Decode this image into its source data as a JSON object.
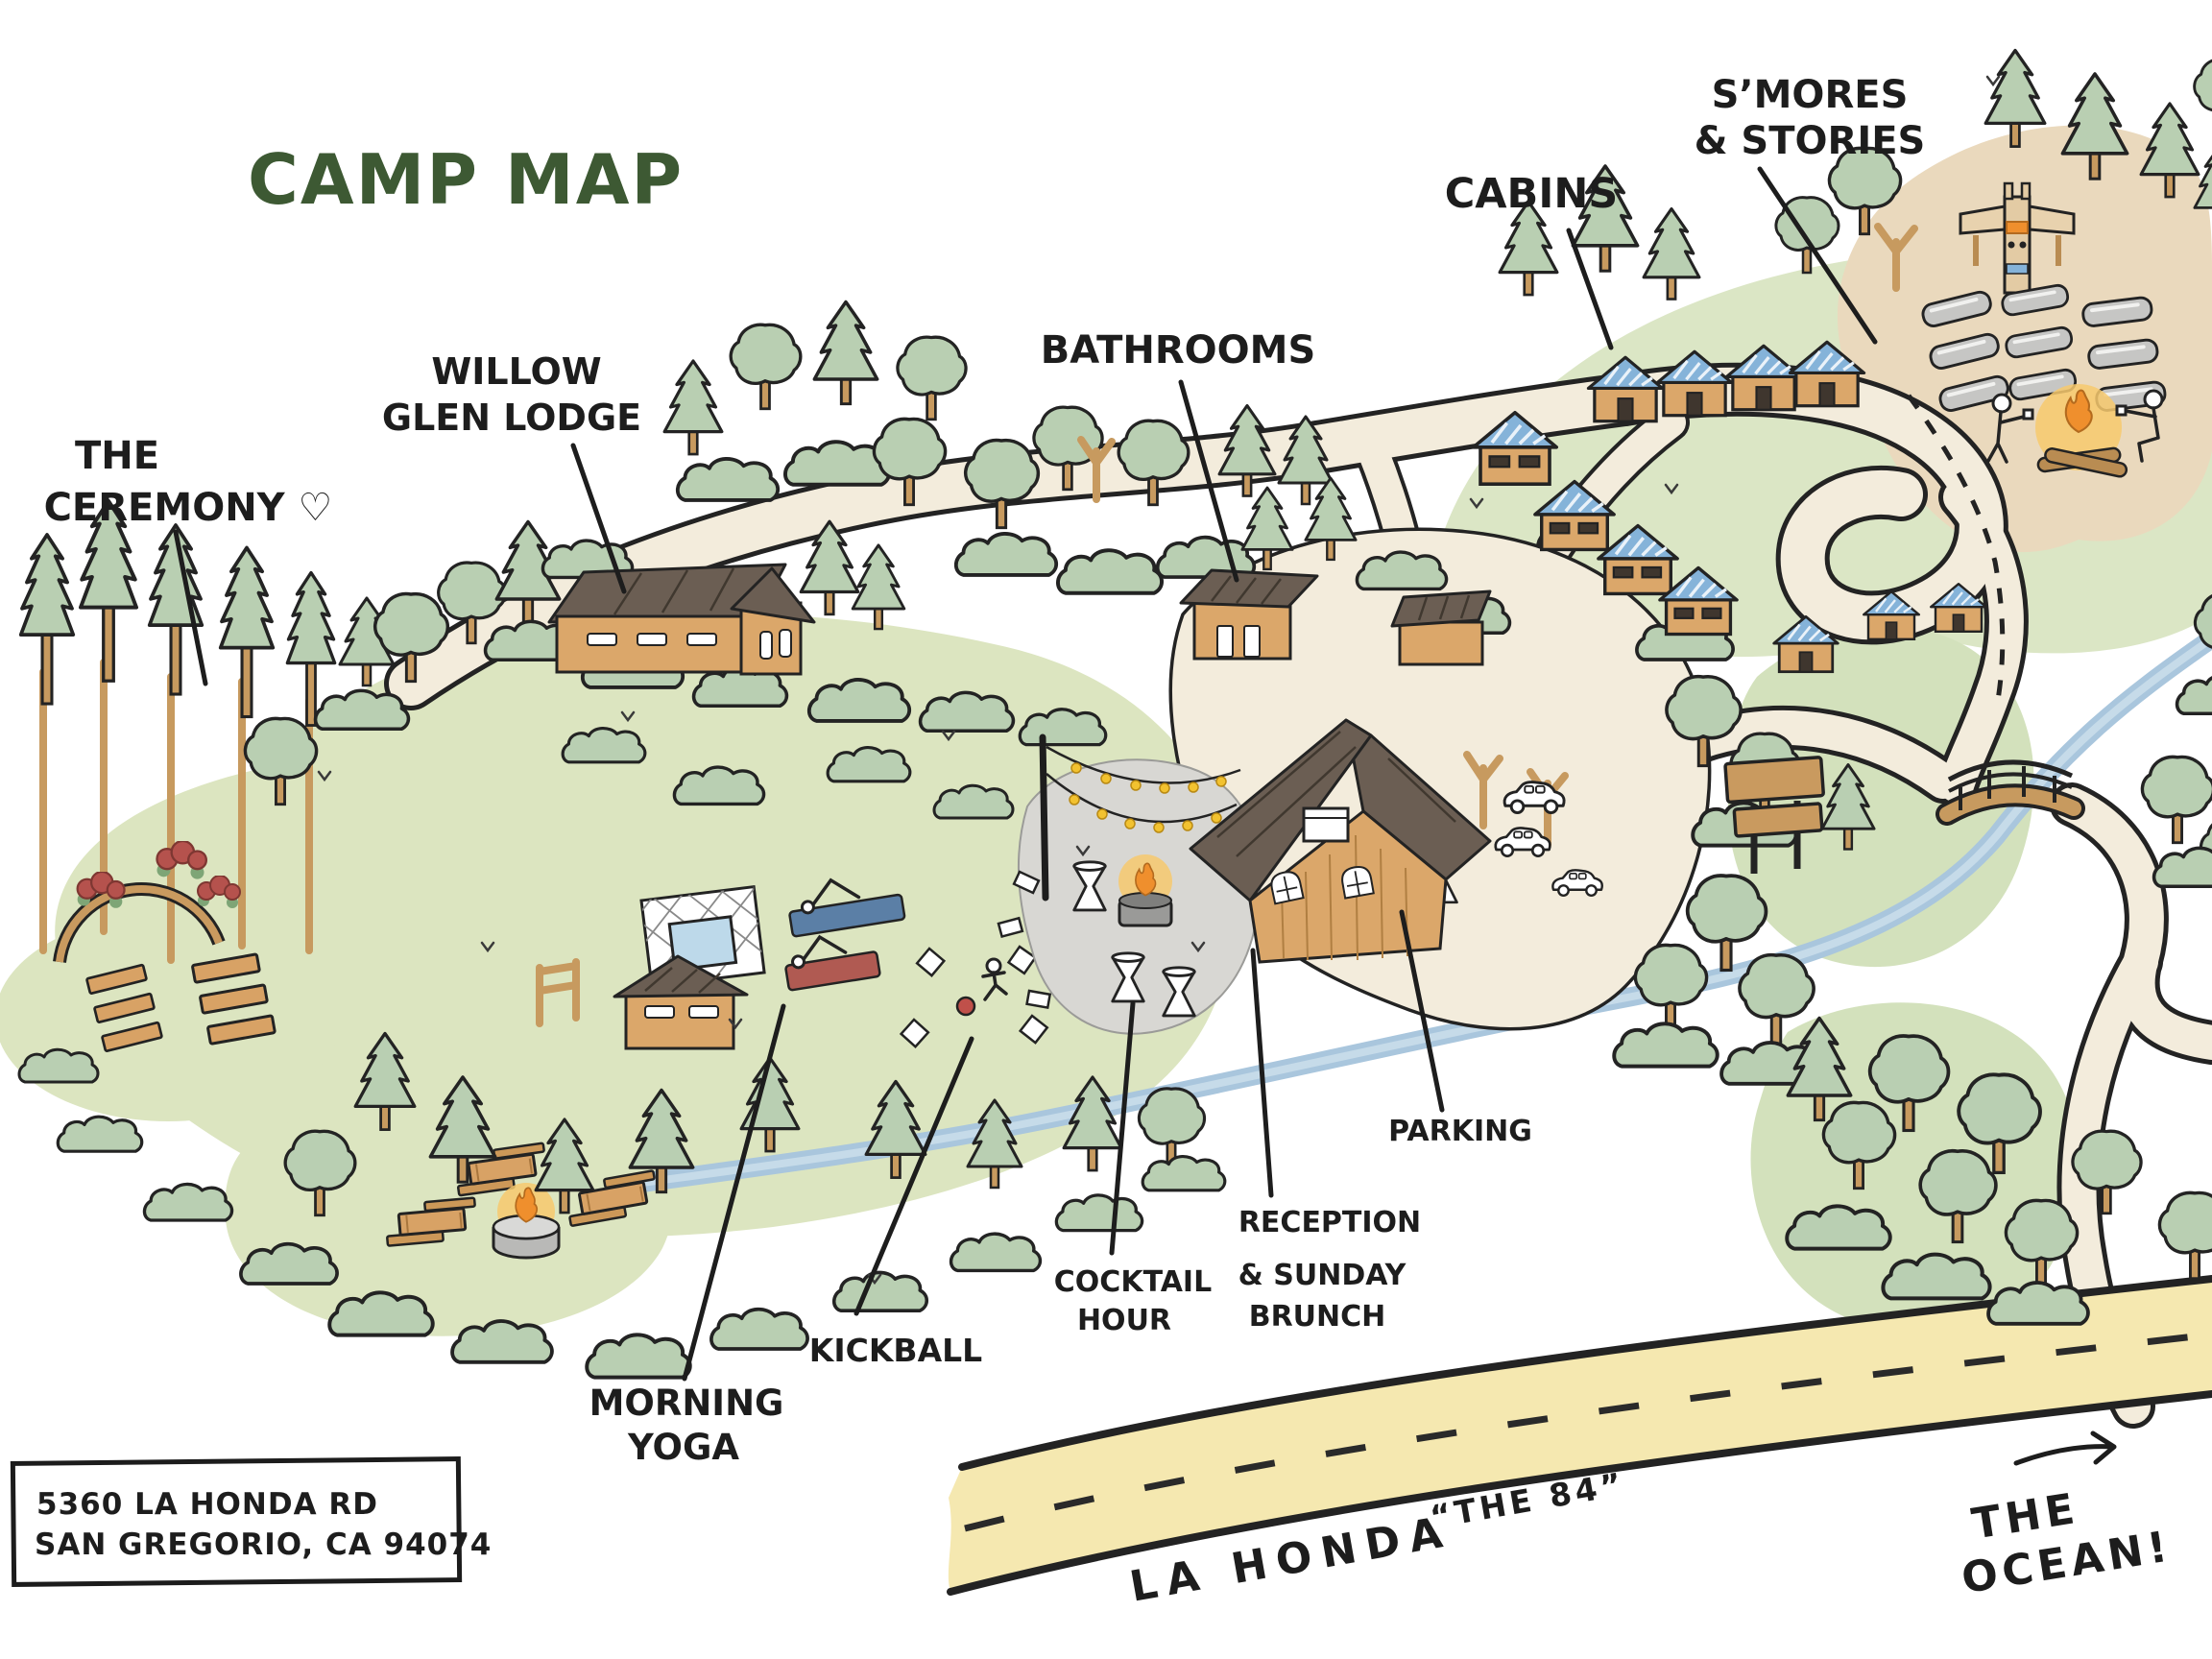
{
  "title": "CAMP MAP",
  "labels": {
    "ceremony": [
      "THE",
      "CEREMONY ♡"
    ],
    "willow": [
      "WILLOW",
      "GLEN LODGE"
    ],
    "bathrooms": [
      "BATHROOMS"
    ],
    "cabins": [
      "CABINS"
    ],
    "smores": [
      "S’MORES",
      "& STORIES"
    ],
    "parking": [
      "PARKING"
    ],
    "reception": [
      "RECEPTION",
      "& SUNDAY",
      "BRUNCH"
    ],
    "cocktail": [
      "COCKTAIL",
      "HOUR"
    ],
    "kickball": [
      "KICKBALL"
    ],
    "yoga": [
      "MORNING",
      "YOGA"
    ]
  },
  "address": [
    "5360 LA HONDA RD",
    "SAN GREGORIO, CA 94074"
  ],
  "highway": {
    "name": "LA HONDA",
    "nickname": "“THE 84”"
  },
  "ocean": [
    "THE",
    "OCEAN!"
  ],
  "colors": {
    "title_green": "#3d5933",
    "ink": "#232323",
    "tree_fill": "#b9cfb2",
    "grass": "#dce5c0",
    "grass_dark": "#d3e1bc",
    "trunk": "#c79a5f",
    "road_fill": "#f3ecdc",
    "ground_tan": "#ead9bd",
    "river_blue": "#a9c6dd",
    "highway_yellow": "#f5e8b0",
    "building_brown": "#dba76a",
    "roof_dark": "#6b5e53",
    "roof_blue": "#85b3d9",
    "wood": "#d8a265",
    "fire_orange": "#ef8f2d",
    "fire_glow": "#f7c96d",
    "flower_red": "#b5524d",
    "pool_blue": "#bdd9ea"
  }
}
